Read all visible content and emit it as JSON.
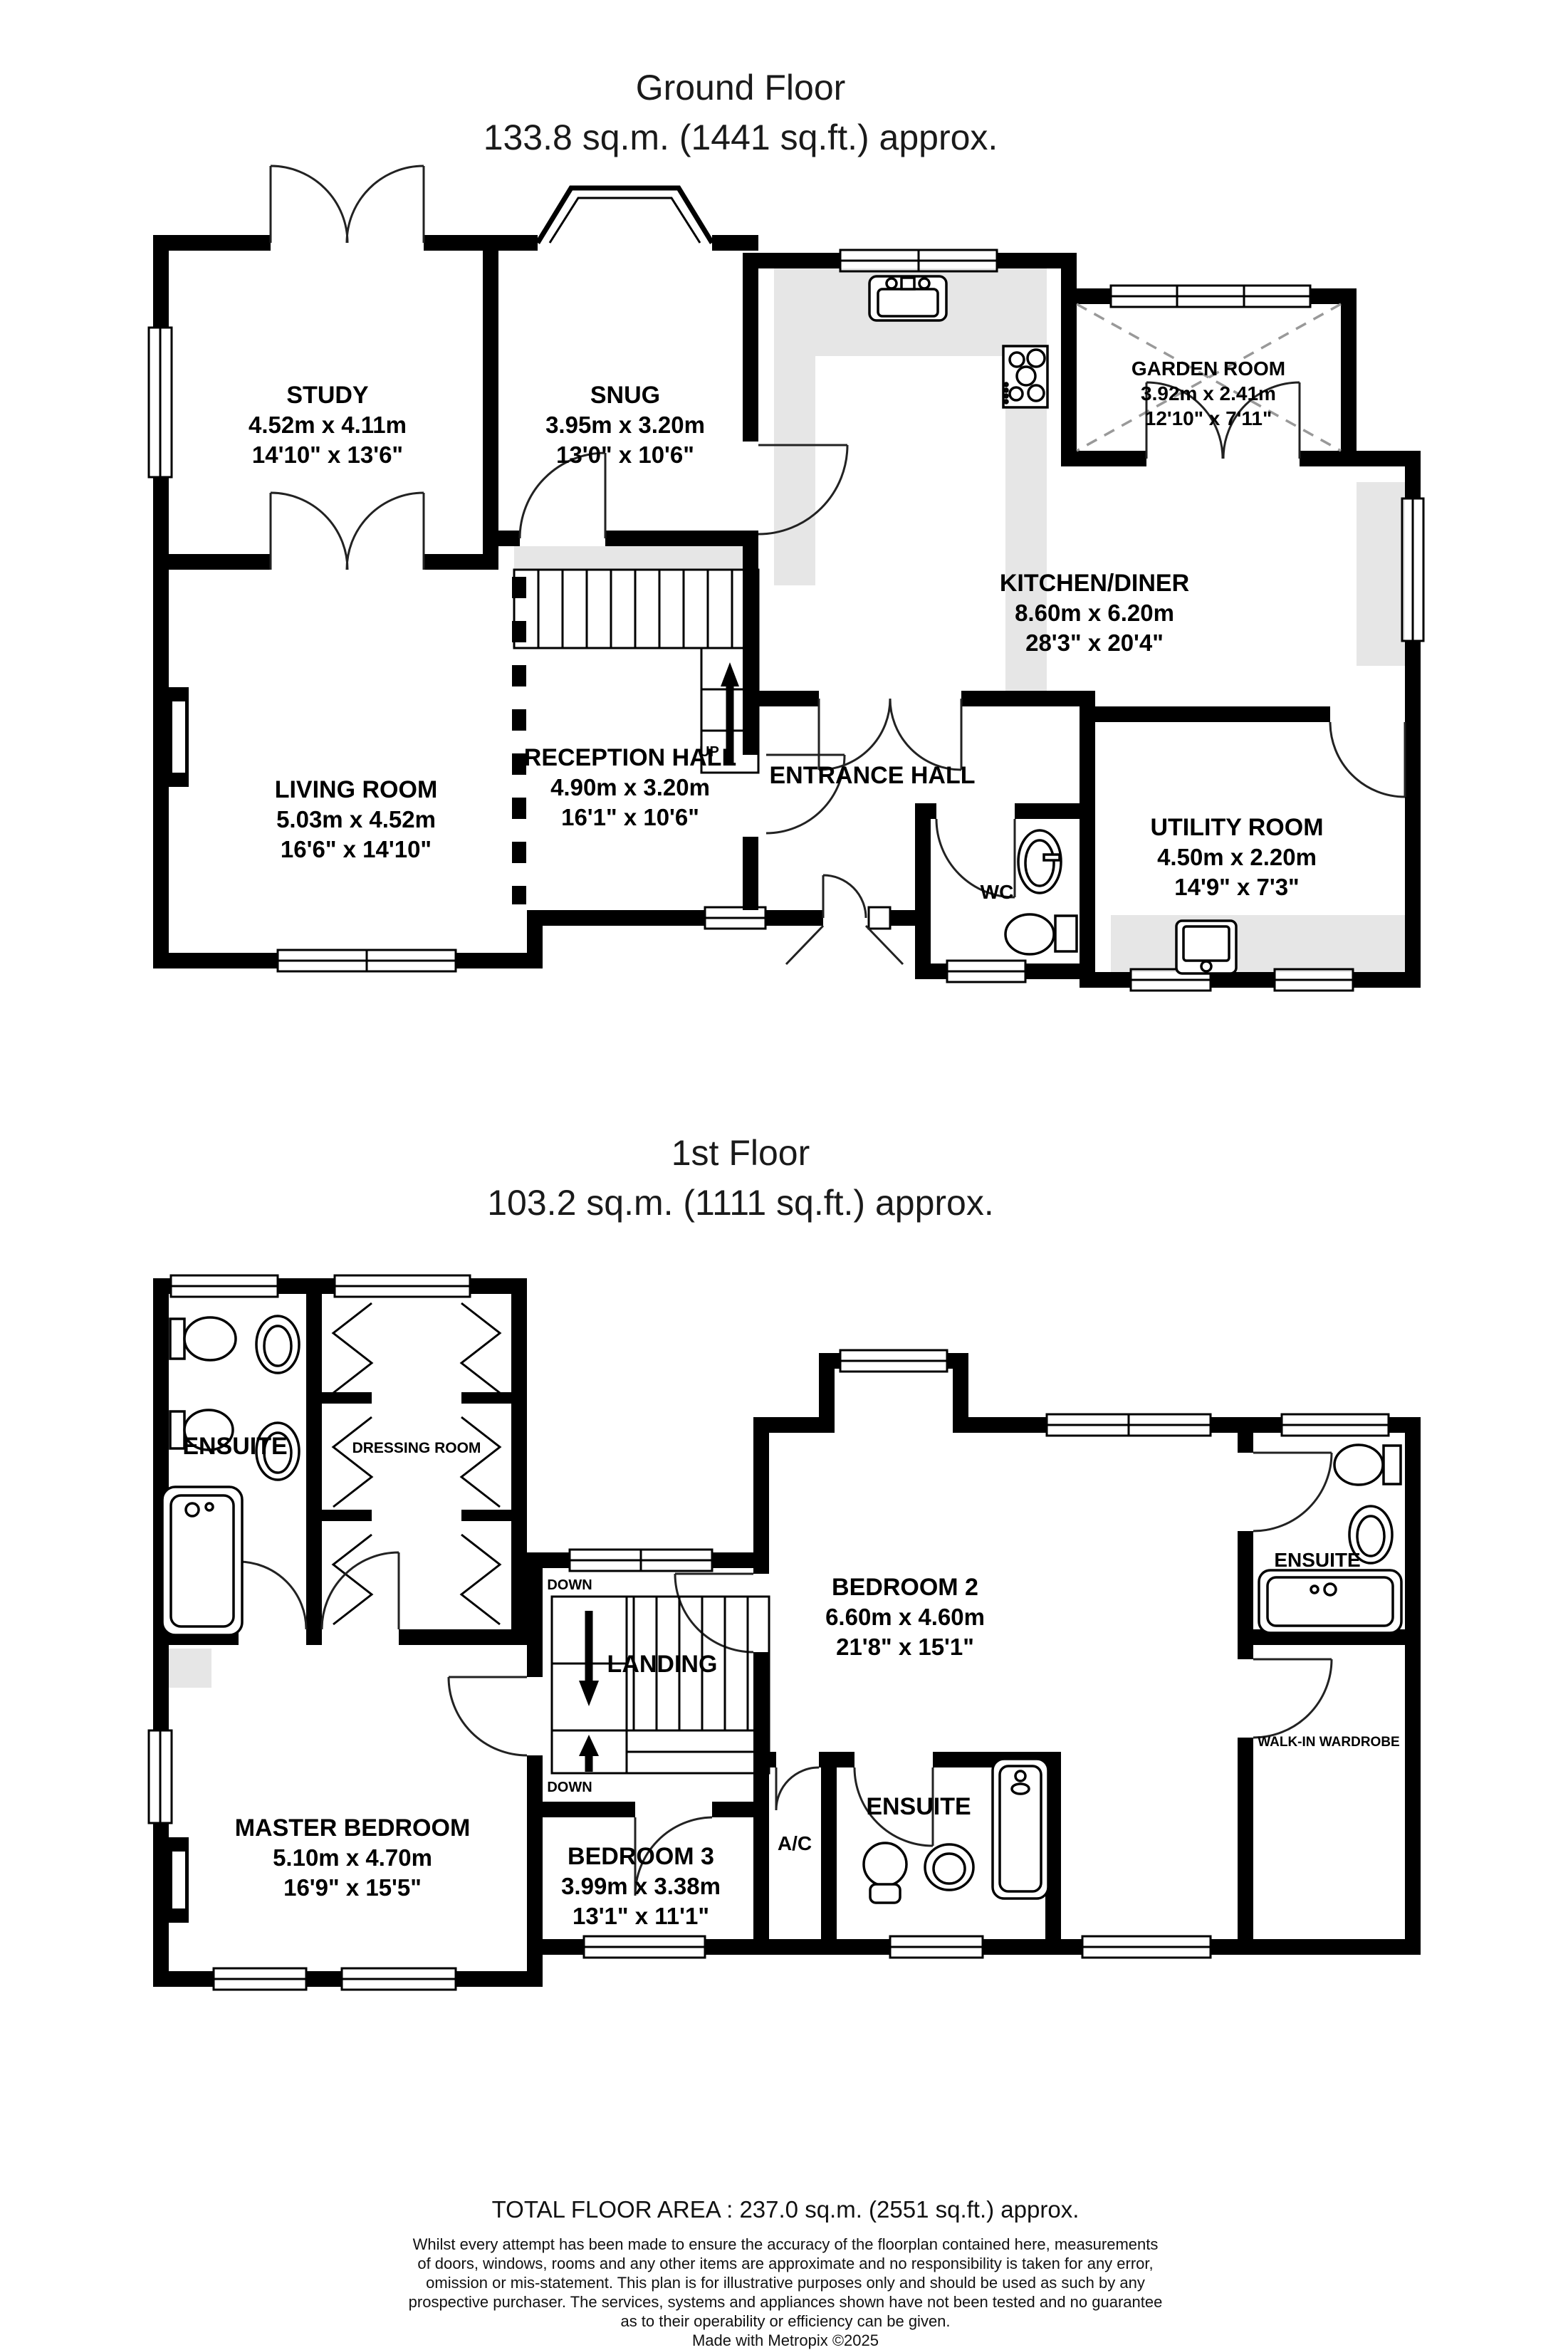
{
  "ground_floor": {
    "title_line1": "Ground Floor",
    "title_line2": "133.8 sq.m. (1441 sq.ft.) approx.",
    "rooms": {
      "study": {
        "name": "STUDY",
        "metric": "4.52m x 4.11m",
        "imperial": "14'10\" x 13'6\""
      },
      "snug": {
        "name": "SNUG",
        "metric": "3.95m x 3.20m",
        "imperial": "13'0\" x 10'6\""
      },
      "garden_room": {
        "name": "GARDEN ROOM",
        "metric": "3.92m x 2.41m",
        "imperial": "12'10\" x 7'11\""
      },
      "kitchen_diner": {
        "name": "KITCHEN/DINER",
        "metric": "8.60m x 6.20m",
        "imperial": "28'3\" x 20'4\""
      },
      "living_room": {
        "name": "LIVING ROOM",
        "metric": "5.03m x 4.52m",
        "imperial": "16'6\" x 14'10\""
      },
      "reception_hall": {
        "name": "RECEPTION HALL",
        "metric": "4.90m x 3.20m",
        "imperial": "16'1\" x 10'6\""
      },
      "entrance_hall": {
        "name": "ENTRANCE HALL"
      },
      "utility_room": {
        "name": "UTILITY ROOM",
        "metric": "4.50m x 2.20m",
        "imperial": "14'9\" x 7'3\""
      },
      "wc": {
        "name": "WC"
      }
    },
    "labels": {
      "up": "UP"
    }
  },
  "first_floor": {
    "title_line1": "1st Floor",
    "title_line2": "103.2 sq.m. (1111 sq.ft.) approx.",
    "rooms": {
      "ensuite_top_left": {
        "name": "ENSUITE"
      },
      "dressing_room": {
        "name": "DRESSING ROOM"
      },
      "master_bedroom": {
        "name": "MASTER BEDROOM",
        "metric": "5.10m x 4.70m",
        "imperial": "16'9\" x 15'5\""
      },
      "landing": {
        "name": "LANDING"
      },
      "bedroom_2": {
        "name": "BEDROOM 2",
        "metric": "6.60m x 4.60m",
        "imperial": "21'8\" x 15'1\""
      },
      "bedroom_3": {
        "name": "BEDROOM 3",
        "metric": "3.99m x 3.38m",
        "imperial": "13'1\" x 11'1\""
      },
      "ensuite_top_right": {
        "name": "ENSUITE"
      },
      "ensuite_bottom": {
        "name": "ENSUITE"
      },
      "walk_in_wardrobe": {
        "name": "WALK-IN WARDROBE"
      },
      "ac_cupboard": {
        "name": "A/C"
      }
    },
    "labels": {
      "down_upper": "DOWN",
      "down_lower": "DOWN"
    }
  },
  "footer": {
    "total_area": "TOTAL FLOOR AREA : 237.0 sq.m. (2551 sq.ft.) approx.",
    "disclaimer_lines": [
      "Whilst every attempt has been made to ensure the accuracy of the floorplan contained here, measurements",
      "of doors, windows, rooms and any other items are approximate and no responsibility is taken for any error,",
      "omission or mis-statement. This plan is for illustrative purposes only and should be used as such by any",
      "prospective purchaser. The services, systems and appliances shown have not been tested and no guarantee",
      "as to their operability or efficiency can be given."
    ],
    "credit": "Made with Metropix ©2025"
  },
  "colors": {
    "wall": "#000000",
    "counter": "#e6e6e6",
    "background": "#ffffff"
  }
}
